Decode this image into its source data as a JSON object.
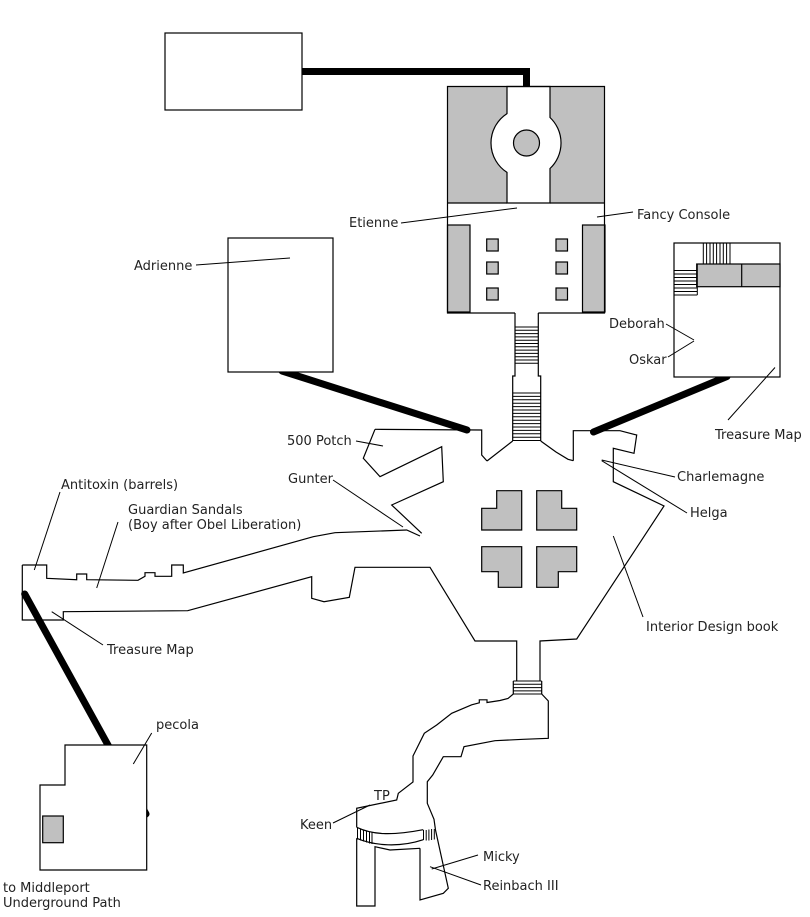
{
  "canvas": {
    "width": 810,
    "height": 917,
    "background_color": "#ffffff",
    "wall_color": "#000000",
    "shade_color": "#c0c0c0",
    "text_color": "#222222"
  },
  "map": {
    "description": "Hand-drawn ship interior map with rooms, ladders and labeled points of interest",
    "rooms": [
      "storage room (top left)",
      "fancy console room",
      "adrienne room",
      "deborah-oskar room",
      "central hall",
      "west corridor",
      "pecola room",
      "south passage"
    ],
    "exit_note": "to Middleport Underground Path"
  },
  "labels": {
    "etienne": "Etienne",
    "fancy_console": "Fancy Console",
    "adrienne": "Adrienne",
    "deborah": "Deborah",
    "oskar": "Oskar",
    "treasure_map_right": "Treasure Map",
    "potch_500": "500 Potch",
    "gunter": "Gunter",
    "charlemagne": "Charlemagne",
    "helga": "Helga",
    "antitoxin": "Antitoxin (barrels)",
    "guardian_sandals_line1": "Guardian Sandals",
    "guardian_sandals_line2": "(Boy after Obel Liberation)",
    "treasure_map_left": "Treasure Map",
    "interior_design_book": "Interior Design book",
    "pecola": "pecola",
    "tp": "TP",
    "keen": "Keen",
    "micky": "Micky",
    "reinbach_iii": "Reinbach III",
    "exit_note_line1": "to Middleport",
    "exit_note_line2": "Underground Path"
  }
}
